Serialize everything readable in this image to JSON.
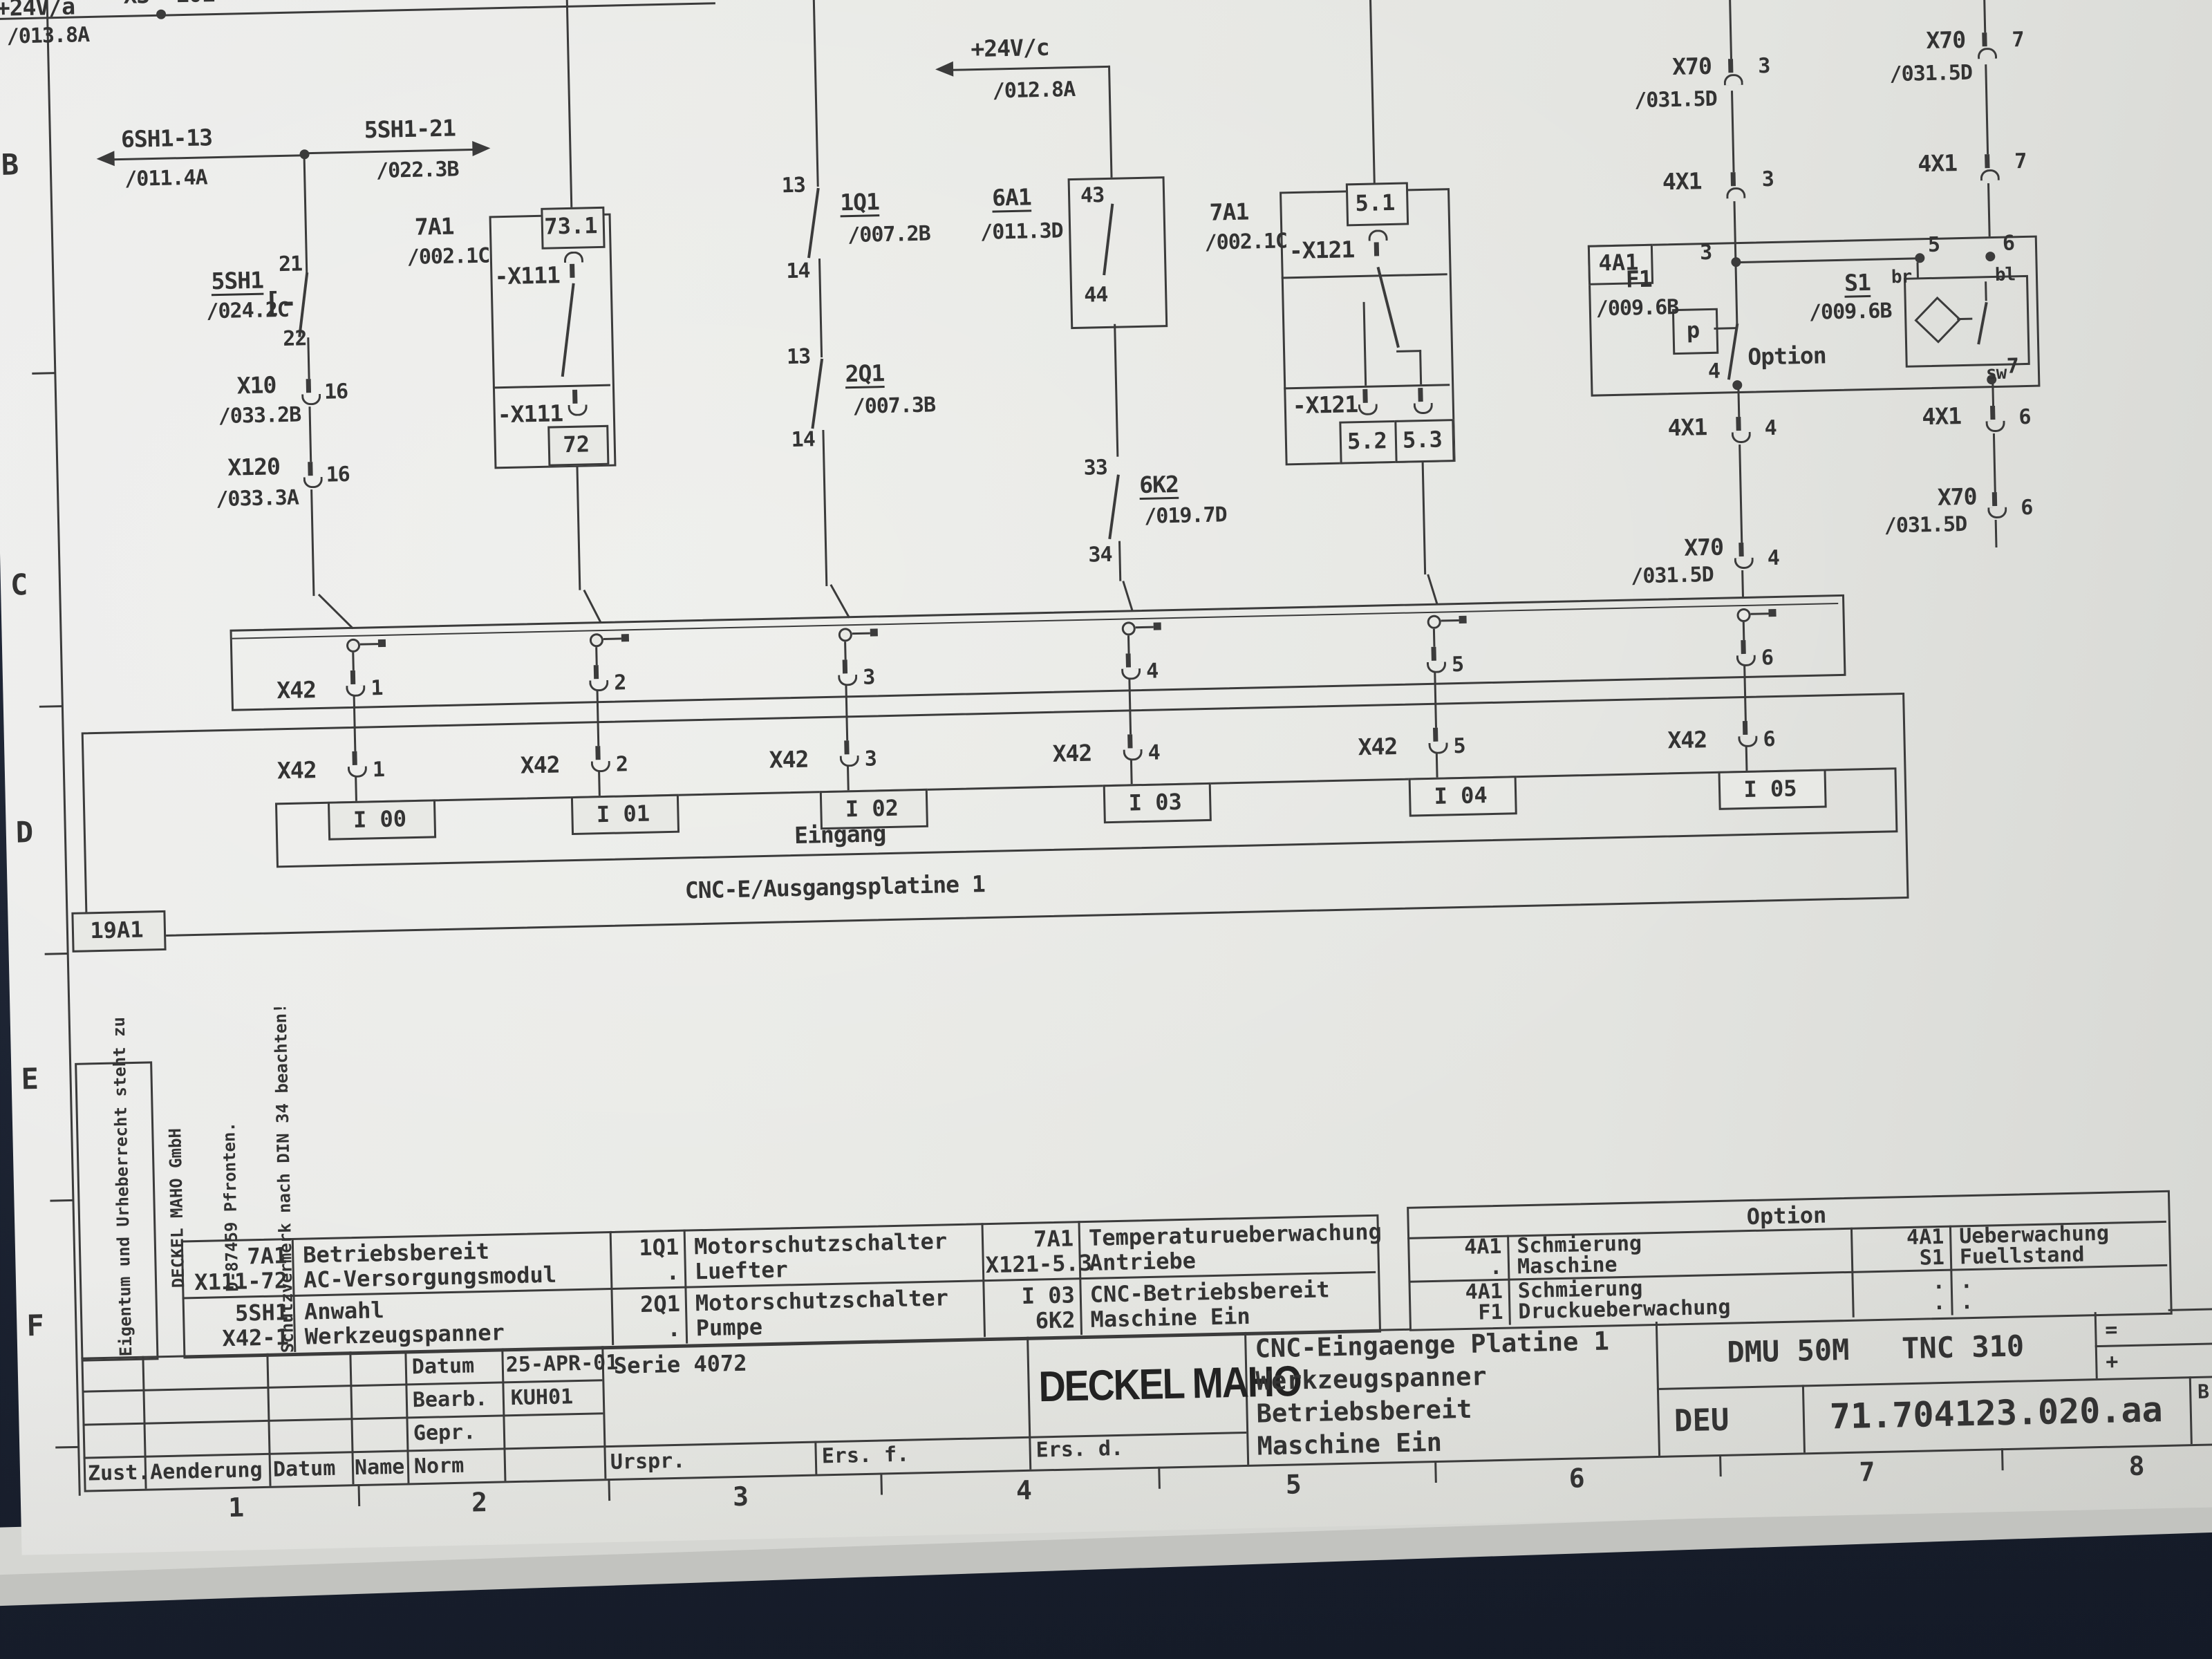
{
  "colors": {
    "paper": "#e8e9e5",
    "ink": "#3b3b3b",
    "surface": "#1d2433"
  },
  "frame": {
    "rows": [
      "B",
      "C",
      "D",
      "E",
      "F"
    ],
    "cols": [
      "1",
      "2",
      "3",
      "4",
      "5",
      "6",
      "7",
      "8"
    ]
  },
  "rails": {
    "a_label": "+24V/a",
    "a_ref": "/013.8A",
    "x3": "X3  101",
    "c_label": "+24V/c",
    "c_ref": "/012.8A"
  },
  "col1": {
    "left_label": "6SH1-13",
    "left_ref": "/011.4A",
    "right_label": "5SH1-21",
    "right_ref": "/022.3B",
    "sw_label": "5SH1",
    "sw_ref": "/024.2C",
    "sw_top": "21",
    "sw_bot": "22",
    "bracket": "[-",
    "x10_label": "X10",
    "x10_ref": "/033.2B",
    "x10_pin": "16",
    "x120_label": "X120",
    "x120_ref": "/033.3A",
    "x120_pin": "16"
  },
  "col2": {
    "dev": "7A1",
    "dev_ref": "/002.1C",
    "conn_top": "-X111",
    "pin_top": "73.1",
    "conn_bot": "-X111",
    "pin_bot": "72"
  },
  "col3": {
    "q1": "1Q1",
    "q1_ref": "/007.2B",
    "q1_top": "13",
    "q1_bot": "14",
    "q2": "2Q1",
    "q2_ref": "/007.3B",
    "q2_top": "13",
    "q2_bot": "14"
  },
  "col4": {
    "relay": "6A1",
    "relay_ref": "/011.3D",
    "relay_top": "43",
    "relay_bot": "44",
    "k": "6K2",
    "k_ref": "/019.7D",
    "k_top": "33",
    "k_bot": "34"
  },
  "col5": {
    "dev": "7A1",
    "dev_ref": "/002.1C",
    "conn": "-X121",
    "pin_top": "5.1",
    "conn2": "-X121",
    "pin_b1": "5.2",
    "pin_b2": "5.3"
  },
  "right": {
    "x70": "X70",
    "x70_ref": "/031.5D",
    "x4x1": "4X1",
    "box": "4A1",
    "p3": "3",
    "p4": "4",
    "p6": "6",
    "p7": "7",
    "n3": "3",
    "n4": "4",
    "n5": "5",
    "n6": "6",
    "n7": "7",
    "br": "br",
    "bl": "bl",
    "sw": "sw",
    "f1": "F1",
    "f1_ref": "/009.6B",
    "p_sym": "p",
    "s1": "S1",
    "s1_ref": "/009.6B",
    "option": "Option"
  },
  "board": {
    "x42": "X42",
    "pins": [
      "1",
      "2",
      "3",
      "4",
      "5",
      "6"
    ],
    "inputs": [
      "I 00",
      "I 01",
      "I 02",
      "I 03",
      "I 04",
      "I 05"
    ],
    "eingang": "Eingang",
    "name": "CNC-E/Ausgangsplatine 1",
    "ref": "19A1"
  },
  "legend": {
    "r1": [
      {
        "c": [
          "7A1",
          "X111-72"
        ],
        "d": [
          "Betriebsbereit",
          "AC-Versorgungsmodul"
        ]
      },
      {
        "c": [
          "1Q1",
          "."
        ],
        "d": [
          "Motorschutzschalter",
          "Luefter"
        ]
      },
      {
        "c": [
          "7A1",
          "X121-5.3"
        ],
        "d": [
          "Temperaturueberwachung",
          "Antriebe"
        ]
      }
    ],
    "r2": [
      {
        "c": [
          "5SH1",
          "X42-1"
        ],
        "d": [
          "Anwahl",
          "Werkzeugspanner"
        ]
      },
      {
        "c": [
          "2Q1",
          "."
        ],
        "d": [
          "Motorschutzschalter",
          "Pumpe"
        ]
      },
      {
        "c": [
          "I 03",
          "6K2"
        ],
        "d": [
          "CNC-Betriebsbereit",
          "Maschine Ein"
        ]
      }
    ]
  },
  "option_table": {
    "header": "Option",
    "r1": {
      "c1": [
        "4A1",
        "."
      ],
      "d1": [
        "Schmierung",
        "Maschine"
      ],
      "c2": [
        "4A1",
        "S1"
      ],
      "d2": [
        "Ueberwachung",
        "Fuellstand"
      ]
    },
    "r2": {
      "c1": [
        "4A1",
        "F1"
      ],
      "d1": [
        "Schmierung",
        "Druckueberwachung"
      ],
      "c2": [
        ".",
        "."
      ],
      "d2": [
        ".",
        "."
      ]
    }
  },
  "title_block": {
    "brand": "DECKEL MAHO",
    "titles": [
      "CNC-Eingaenge Platine 1",
      "Werkzeugspanner",
      "Betriebsbereit",
      "Maschine Ein"
    ],
    "machine": "DMU 50M   TNC 310",
    "lang": "DEU",
    "doc": "71.704123.020.aa",
    "eq": "=",
    "plus": "+",
    "corner": "B",
    "datum": "Datum",
    "datum_v": "25-APR-01",
    "bearb": "Bearb.",
    "bearb_v": "KUH01",
    "gepr": "Gepr.",
    "norm": "Norm",
    "serie": "Serie 4072",
    "urspr": "Urspr.",
    "ers_f": "Ers. f.",
    "ers_d": "Ers. d.",
    "zust": "Zust.",
    "aend": "Aenderung",
    "datum2": "Datum",
    "name": "Name"
  },
  "note": {
    "l1": "Eigentum und Urheberrecht steht zu",
    "l2": "DECKEL MAHO GmbH",
    "l3": "D-87459 Pfronten.",
    "l4": "Schutzvermerk nach DIN 34 beachten!"
  }
}
